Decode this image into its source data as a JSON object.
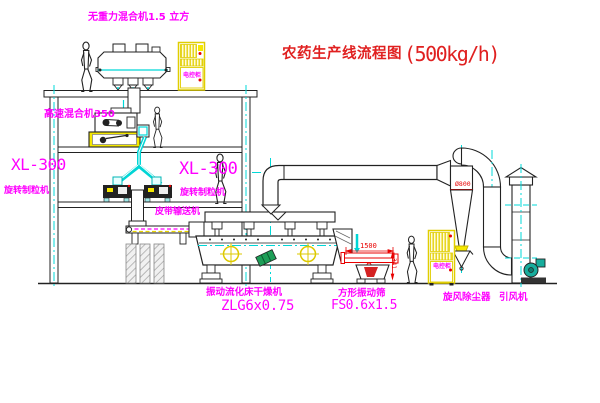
{
  "title": {
    "name": "农药生产线流程图",
    "capacity": "(500kg/h)"
  },
  "equipment_labels": {
    "gravity_mixer": "无重力混合机1.5 立方",
    "high_speed_mixer": "高速混合机350",
    "granulator_left": {
      "model": "XL-300",
      "name": "旋转制粒机"
    },
    "granulator_right": {
      "model": "XL-300",
      "name": "旋转制粒机"
    },
    "belt_conveyor": "皮带输送机",
    "fluid_bed_dryer": {
      "name": "振动流化床干燥机",
      "model": "ZLG6x0.75"
    },
    "square_sieve": {
      "name": "方形振动筛",
      "model": "FS0.6x1.5"
    },
    "cyclone": "旋风除尘器",
    "induced_fan": "引风机",
    "control_cabinet_top": "电控柜",
    "control_cabinet_right": "电控柜"
  },
  "dimensions": {
    "sieve_length": "1500",
    "sieve_height": "341",
    "cyclone_note": "Ø800"
  },
  "colors": {
    "label_magenta": "#ff00ff",
    "title_red": "#e02020",
    "line_black": "#222222",
    "centerline_cyan": "#00d8d8",
    "highlight_yellow": "#f5e800"
  }
}
